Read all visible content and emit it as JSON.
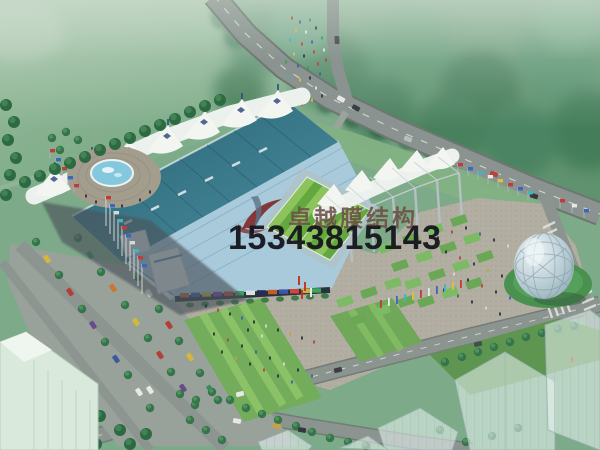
{
  "watermark": {
    "company": "卓越膜结构",
    "phone": "15343815143"
  },
  "palette": {
    "wm-company-color": "#6b5046",
    "wm-phone-color": "#15151d",
    "logo-red": "#7c1f1f",
    "logo-blue": "#5d7287",
    "membrane-white": "#f3f5f1",
    "grandstand-teal": "#2e6b7c",
    "pitch-green-light": "#8cc35d",
    "pitch-green-dark": "#63a83f",
    "water-blue": "#84c8de",
    "plaza-gray": "#b2aea2",
    "forest-green": "#4a8260"
  },
  "scene": {
    "alt": "Aerial rendering of a stadium with white tensile membrane roof, blue grandstand, green pitch, fountain plaza, parking lot, glass dome pavilion, roads, flags and trees"
  }
}
